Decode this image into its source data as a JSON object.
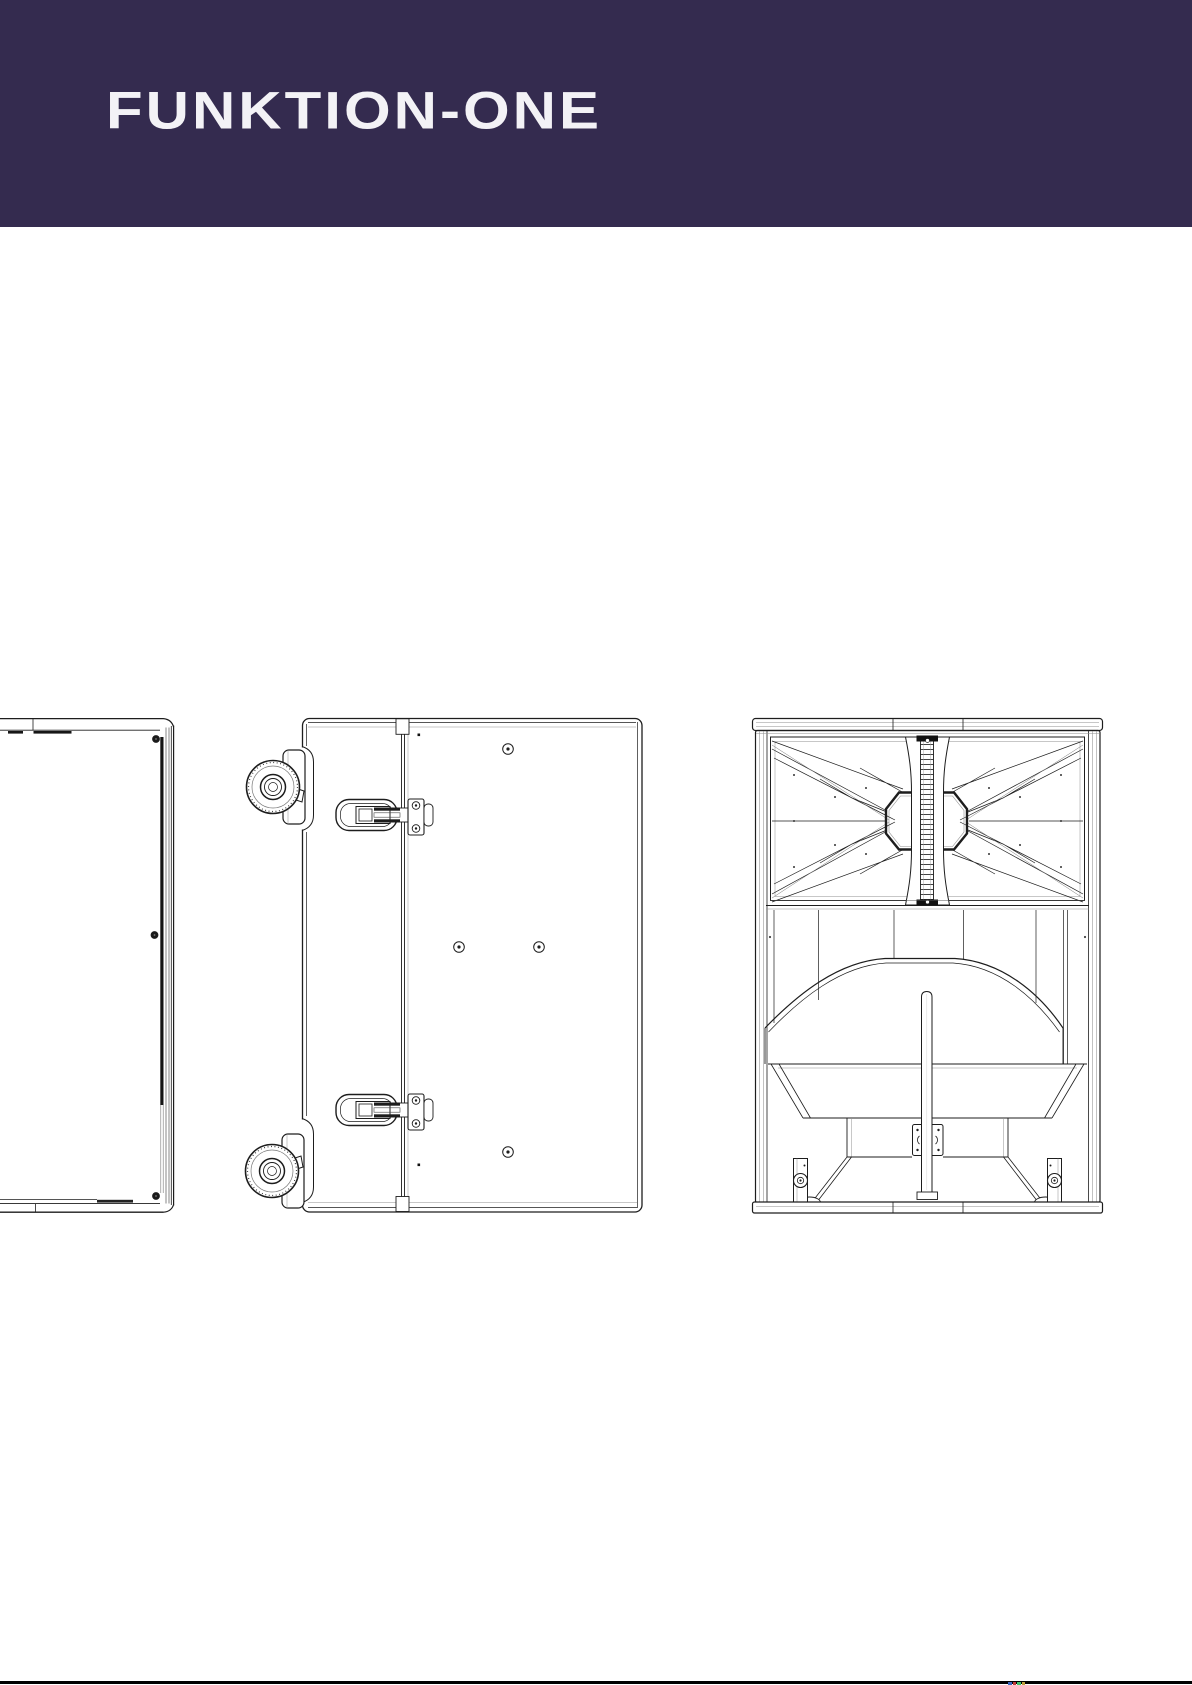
{
  "page": {
    "width": 1192,
    "height": 1685,
    "background": "#ffffff"
  },
  "header": {
    "logo_text": "FUNKTION-ONE",
    "background": "#342B4F",
    "text_color": "#F3F2F6"
  },
  "drawing": {
    "ink": "#1D1D1D",
    "light_ink": "#8F8F8F",
    "views": [
      "left-side-view",
      "side-view-with-casters-and-latches",
      "front-view-horn-and-bass"
    ]
  },
  "footer": {
    "rule_color": "#000000",
    "accent_marks": [
      "#3A66C0",
      "#C03A3A",
      "#3AC06A",
      "#C0A03A"
    ]
  }
}
